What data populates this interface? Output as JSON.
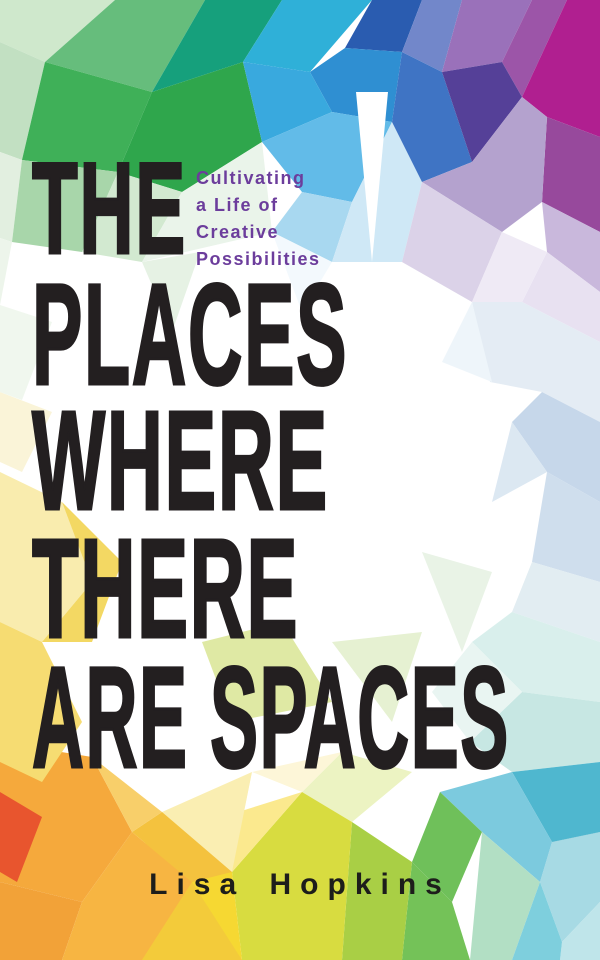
{
  "cover": {
    "title_lines": [
      "THE",
      "PLACES",
      "WHERE",
      "THERE",
      "ARE SPACES"
    ],
    "subtitle_lines": [
      "Cultivating",
      "a Life of",
      "Creative",
      "Possibilities"
    ],
    "author": "Lisa Hopkins",
    "colors": {
      "title_text": "#231f20",
      "subtitle_text": "#6c3d9c",
      "author_text": "#1d1d1b",
      "background": "#ffffff",
      "palette": [
        "#33a94e",
        "#16a07c",
        "#2fb0d8",
        "#2a5cb0",
        "#b01f90",
        "#554098",
        "#b4a2ce",
        "#f5a93c",
        "#e8552e",
        "#f6d832",
        "#a9cf45",
        "#74c258",
        "#4fb7cf"
      ]
    }
  }
}
